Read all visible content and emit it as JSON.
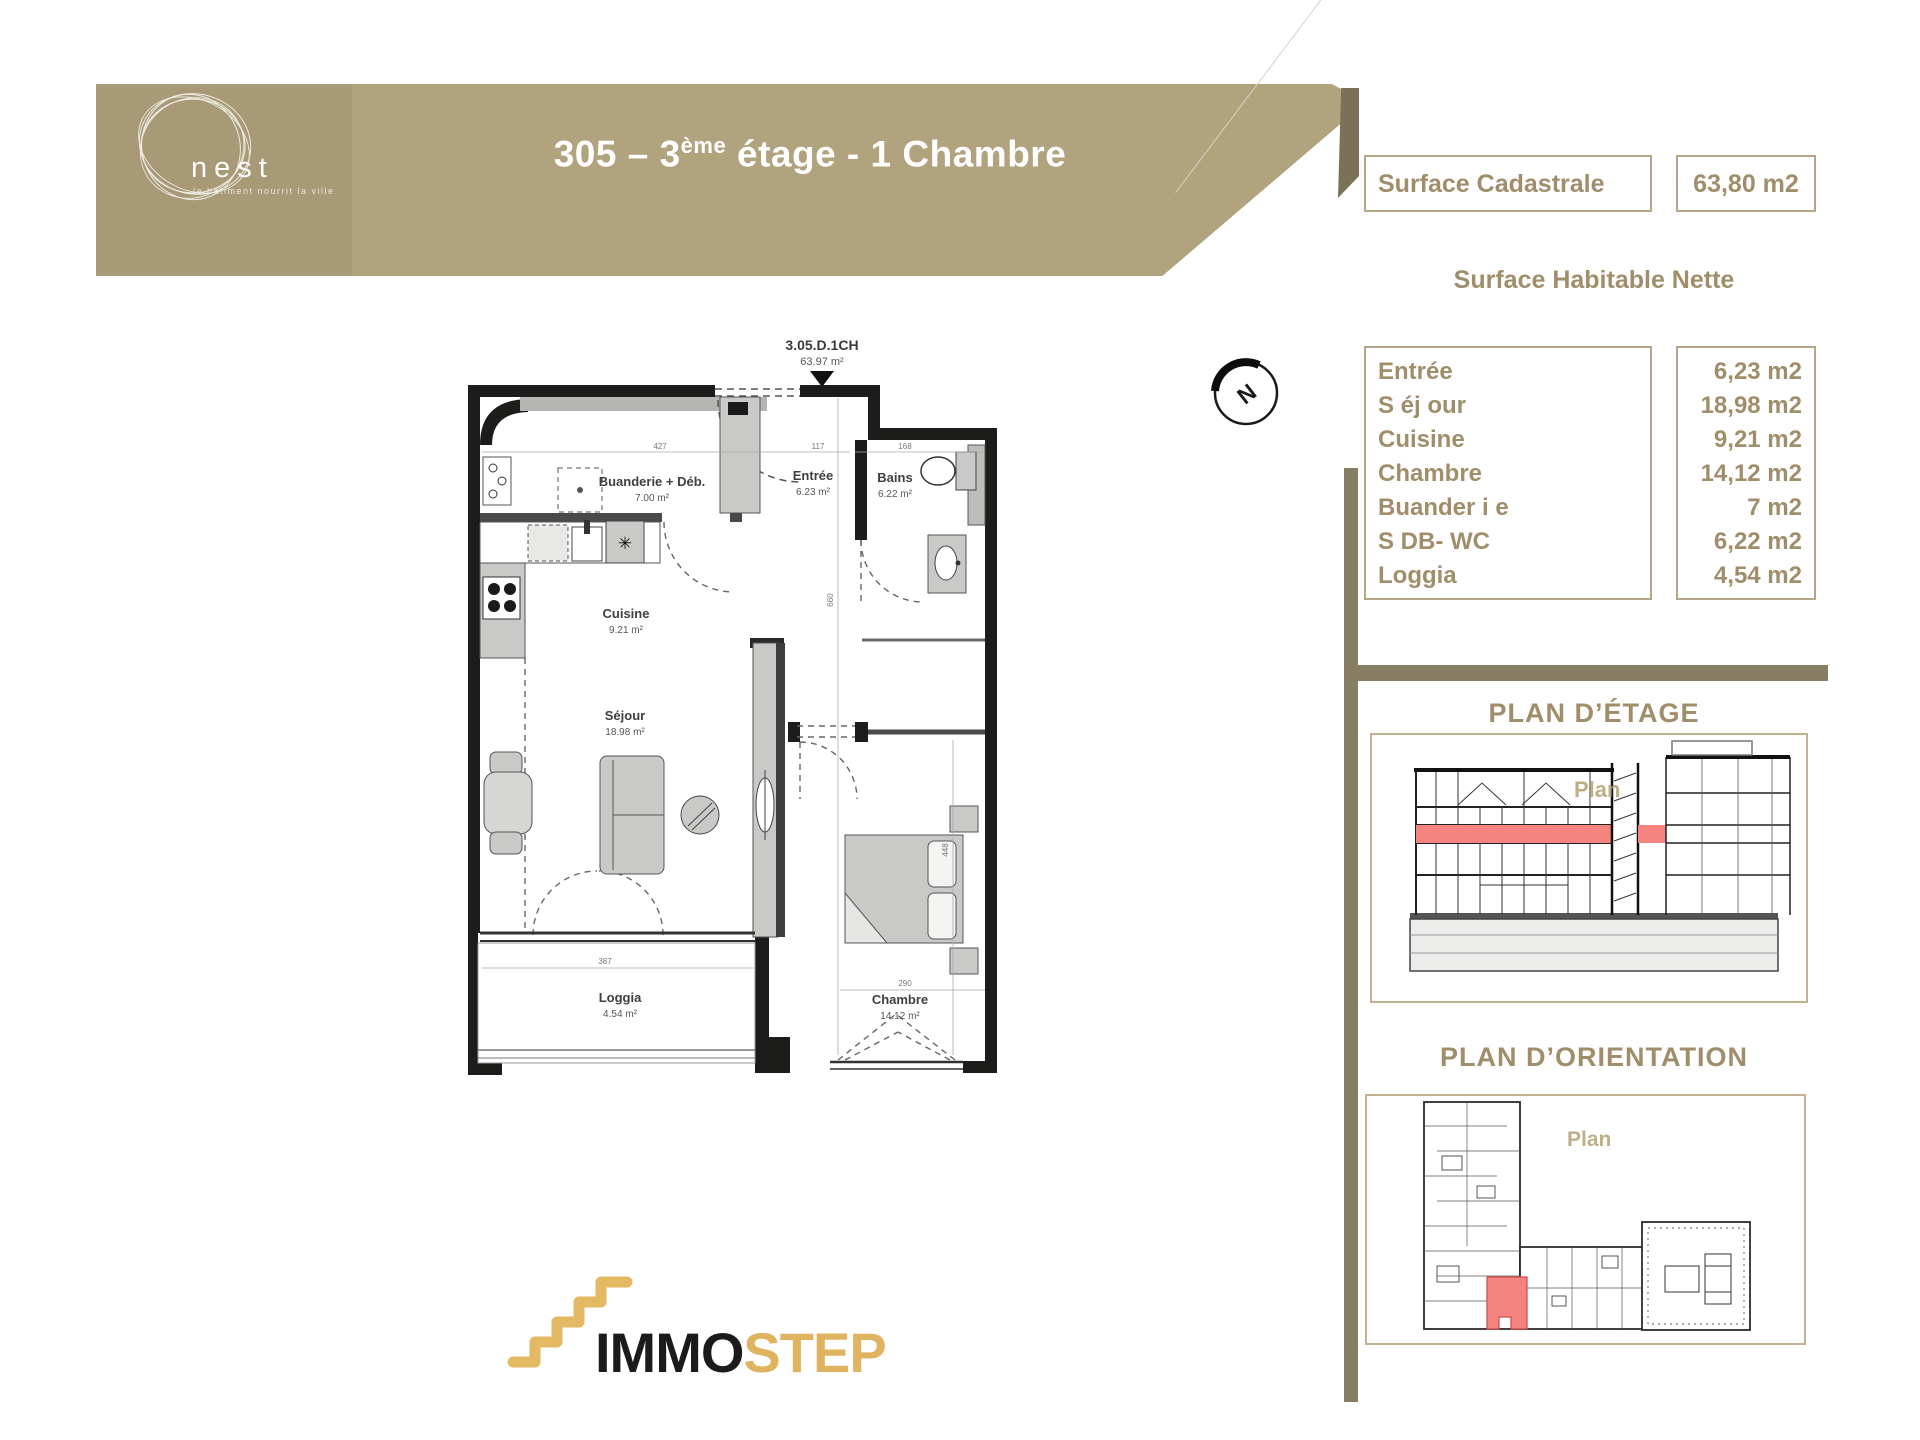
{
  "header": {
    "logo_text": "nest",
    "logo_tagline": "le bâtiment nourrit la ville",
    "title_parts": {
      "main": "305 – 3",
      "sup": "ème",
      "rest": " étage - 1 Chambre"
    }
  },
  "surface_cadastrale": {
    "label": "Surface Cadastrale",
    "value": "63,80 m2"
  },
  "surface_habitable": {
    "title": "Surface Habitable Nette",
    "rows": [
      {
        "label": "Entrée",
        "value": "6,23 m2"
      },
      {
        "label": "S éj our",
        "value": "18,98 m2"
      },
      {
        "label": "Cuisine",
        "value": "9,21 m2"
      },
      {
        "label": "Chambre",
        "value": "14,12 m2"
      },
      {
        "label": "Buander i e",
        "value": "7 m2"
      },
      {
        "label": "S DB- WC",
        "value": "6,22 m2"
      },
      {
        "label": "Loggia",
        "value": "4,54 m2"
      }
    ]
  },
  "floor_plan": {
    "unit_code": "3.05.D.1CH",
    "unit_area": "63.97 m²",
    "rooms": [
      {
        "name": "Buanderie + Déb.",
        "area": "7.00 m²"
      },
      {
        "name": "Entrée",
        "area": "6.23 m²"
      },
      {
        "name": "Bains",
        "area": "6.22 m²"
      },
      {
        "name": "Cuisine",
        "area": "9.21 m²"
      },
      {
        "name": "Séjour",
        "area": "18.98 m²"
      },
      {
        "name": "Loggia",
        "area": "4.54 m²"
      },
      {
        "name": "Chambre",
        "area": "14.12 m²"
      }
    ],
    "dims": [
      "427",
      "117",
      "168",
      "660",
      "448",
      "290",
      "387"
    ],
    "star_symbol": "✳"
  },
  "compass": {
    "letter": "N"
  },
  "plan_etage": {
    "title": "PLAN D’ÉTAGE",
    "watermark": "Plan"
  },
  "plan_orientation": {
    "title": "PLAN D’ORIENTATION",
    "watermark": "Plan"
  },
  "footer_logo": {
    "immo": "IMMO",
    "step": "STEP"
  },
  "colors": {
    "banner_tan": "#b2a37f",
    "logo_block_tan": "#a89a76",
    "olive_bar": "#867d63",
    "accent_text": "#a08e6a",
    "box_border": "#b6a687",
    "highlight_red": "#f5837f",
    "gold": "#dfb35f"
  }
}
